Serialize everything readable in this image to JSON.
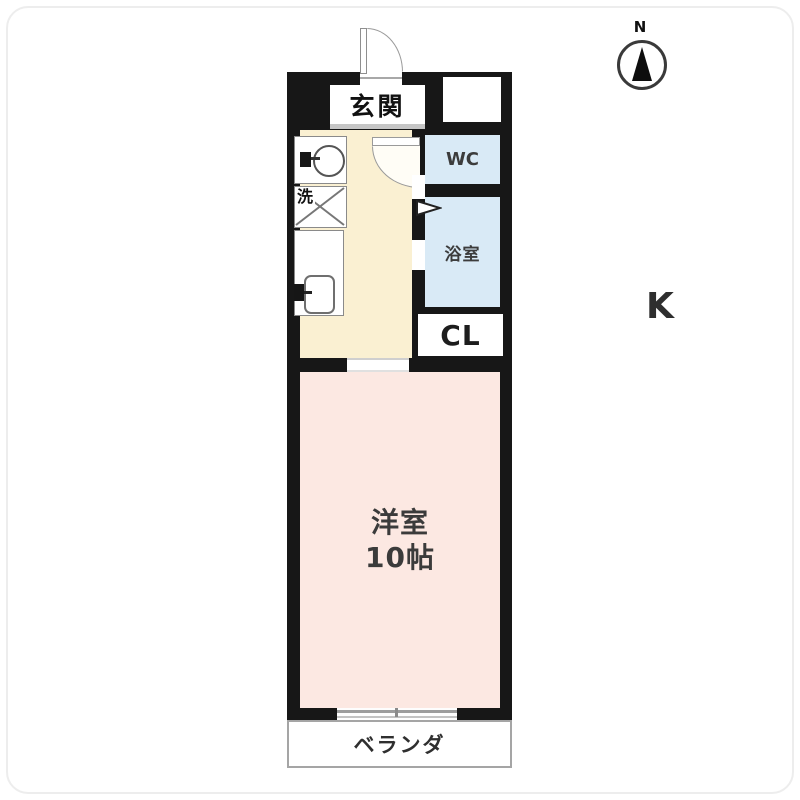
{
  "compass": {
    "north_label": "N"
  },
  "rooms": {
    "genkan": {
      "label": "玄関"
    },
    "wc": {
      "label": "WC"
    },
    "bath": {
      "label": "浴室"
    },
    "closet": {
      "label": "CL"
    },
    "kitchen": {
      "label": "K"
    },
    "laundry": {
      "label": "洗"
    },
    "living": {
      "label": "洋室",
      "size": "10帖"
    },
    "veranda": {
      "label": "ベランダ"
    }
  },
  "icons": {
    "compass": "north-arrow-icon",
    "entrance_door": "hinged-door-arc-icon",
    "kitchen_door": "hinged-door-arc-icon",
    "bath_door": "folding-door-icon",
    "washbasin": "sink-basin-icon",
    "laundry_pan": "washer-pan-x-icon",
    "kitchen_sink": "counter-sink-icon",
    "window": "sliding-window-icon"
  },
  "colors": {
    "wall": "#171717",
    "kitchen_floor": "#faf0d2",
    "wet_area_floor": "#d9eaf6",
    "living_floor": "#fce8e2",
    "veranda_border": "#a5a5a5",
    "door_line": "#9a9a9a",
    "label_text": "#333333"
  }
}
